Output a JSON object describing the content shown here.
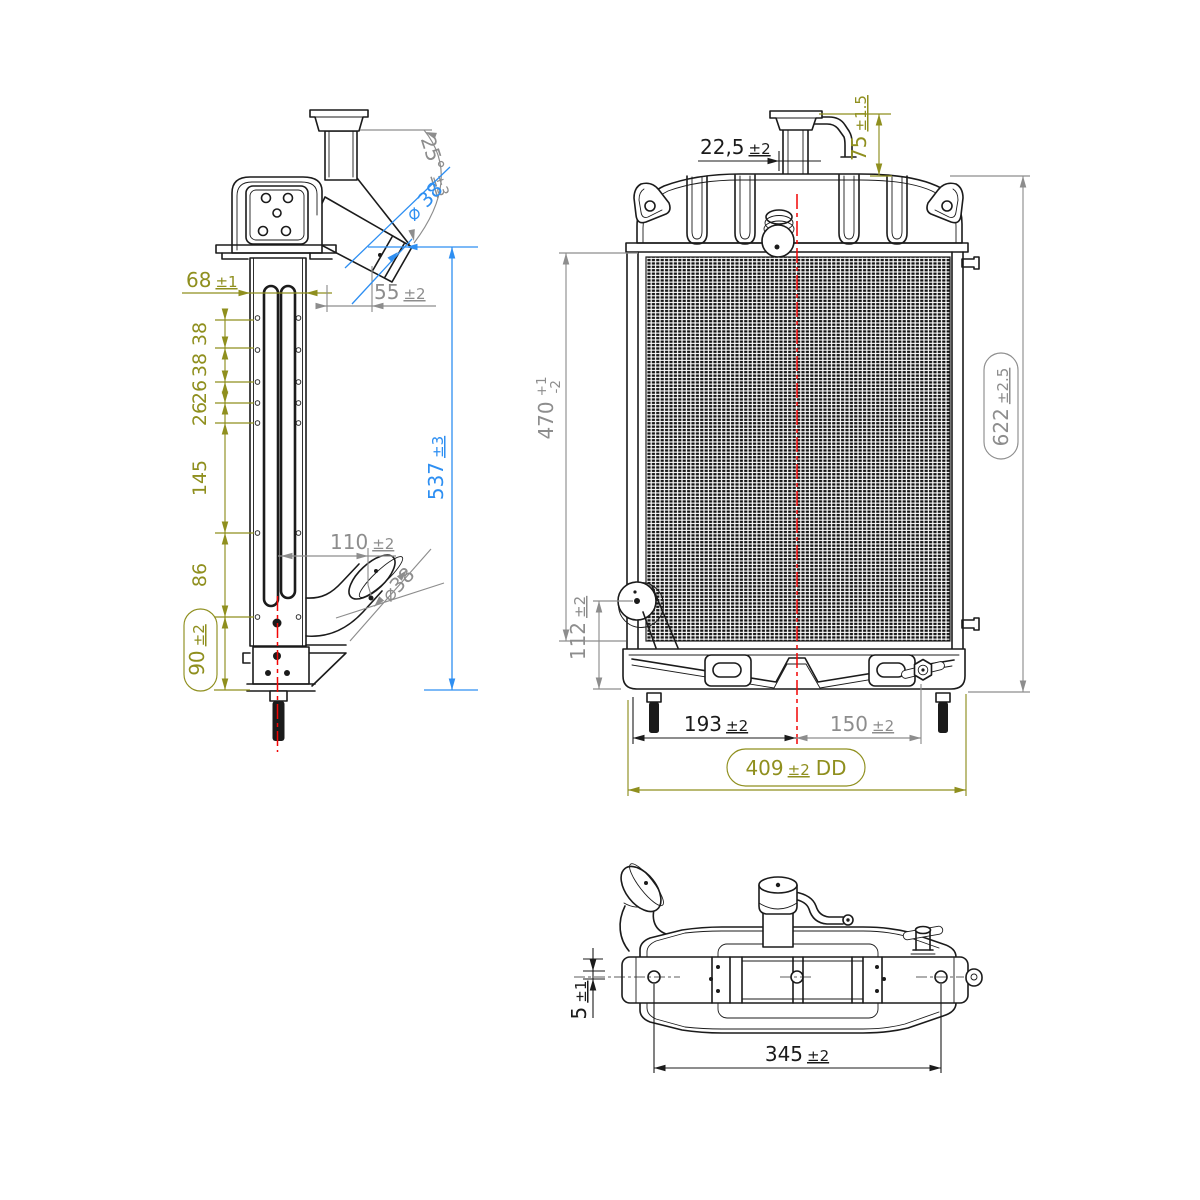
{
  "drawing": {
    "background": "#ffffff",
    "colors": {
      "part_line": "#1b1b1b",
      "dim_gray": "#8d8d8d",
      "dim_olive": "#8f8f1e",
      "dim_blue": "#2e8ff2",
      "centerline_red": "#f20505"
    }
  },
  "side": {
    "tube_width": {
      "value": "68",
      "tol": "±1"
    },
    "stack": [
      "38",
      "38",
      "26",
      "26",
      "145",
      "86"
    ],
    "foot_offset": {
      "value": "90",
      "tol": "±2"
    },
    "total_height": {
      "value": "537",
      "tol": "±3"
    },
    "inlet_reach": {
      "value": "55",
      "tol": "±2"
    },
    "inlet_angle": {
      "value": "25°",
      "tol": "±3"
    },
    "inlet_dia": "⌀ 38",
    "outlet_reach": {
      "value": "110",
      "tol": "±2"
    },
    "outlet_dia": "⌀38"
  },
  "front": {
    "neck_offset": {
      "value": "22,5",
      "tol": "±2"
    },
    "neck_height": {
      "value": "75",
      "tol": "±1.5"
    },
    "core_height": {
      "value": "470",
      "tol_plus": "+1",
      "tol_minus": "-2"
    },
    "total_height": {
      "value": "622",
      "tol": "±2.5"
    },
    "outlet_height": {
      "value": "112",
      "tol": "±2"
    },
    "left_pin_to_center": {
      "value": "193",
      "tol": "±2"
    },
    "center_to_drain": {
      "value": "150",
      "tol": "±2"
    },
    "overall_width": {
      "value": "409",
      "tol": "±2",
      "suffix": "DD"
    }
  },
  "top": {
    "flange_gap": {
      "value": "5",
      "tol": "±1"
    },
    "pin_spacing": {
      "value": "345",
      "tol": "±2"
    }
  }
}
